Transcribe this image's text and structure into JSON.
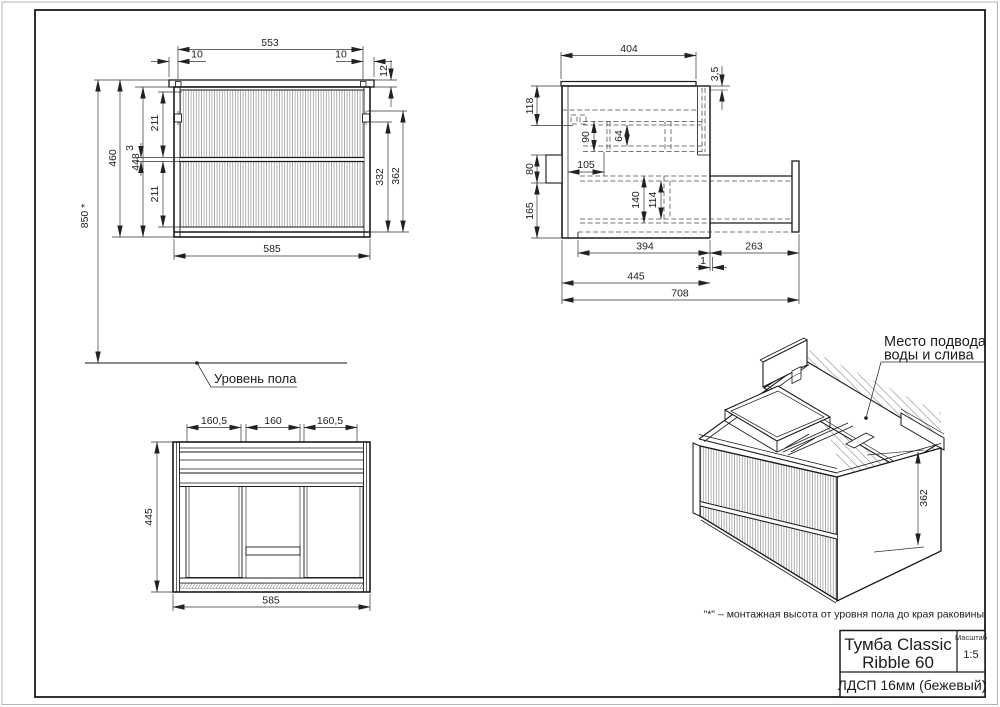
{
  "front_view": {
    "d553": "553",
    "d10l": "10",
    "d10r": "10",
    "d12": "12",
    "d460": "460",
    "d448": "448",
    "d850": "850 *",
    "d211a": "211",
    "d3": "3",
    "d211b": "211",
    "d332": "332",
    "d362": "362",
    "d585": "585"
  },
  "side_view": {
    "d404": "404",
    "d35": "3,5",
    "d118": "118",
    "d90": "90",
    "d64": "64",
    "d105": "105",
    "d80": "80",
    "d165": "165",
    "d140": "140",
    "d114": "114",
    "d394": "394",
    "d263": "263",
    "d1": "1",
    "d445": "445",
    "d708": "708"
  },
  "top_view": {
    "da": "160,5",
    "db": "160",
    "dc": "160,5",
    "d445": "445",
    "d585": "585"
  },
  "iso_view": {
    "d362": "362",
    "note_line1": "Место подвода",
    "note_line2": "воды и слива"
  },
  "labels": {
    "floor_level": "Уровень пола",
    "footnote": "\"*\" – монтажная высота от уровня пола до края раковины"
  },
  "title_block": {
    "product_line1": "Тумба Classic",
    "product_line2": "Ribble 60",
    "scale_label": "Масштаб",
    "scale_value": "1:5",
    "material": "ЛДСП 16мм (бежевый)"
  },
  "colors": {
    "line": "#1a1a1a",
    "hatch": "#8f8f8f",
    "paper": "#ffffff"
  }
}
